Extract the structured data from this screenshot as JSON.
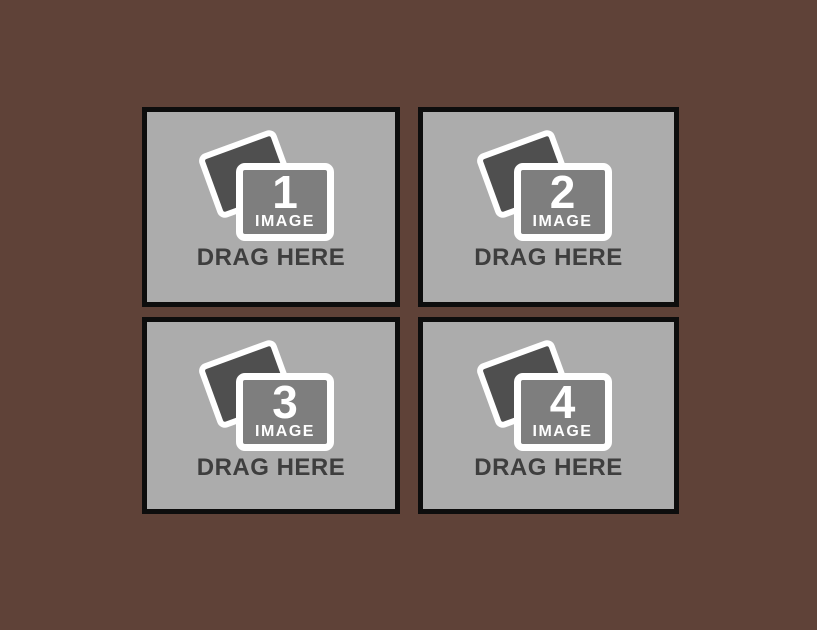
{
  "colors": {
    "bg": "#5f4238",
    "panel": "#acacac",
    "panel-border": "#0d0d0d",
    "frame": "#ffffff",
    "photo-dark": "#4f4f4f",
    "photo-mid": "#7e7e7e",
    "label-text": "#3e3e3e"
  },
  "dropzones": [
    {
      "number": "1",
      "image_label": "IMAGE",
      "drag_label": "DRAG HERE"
    },
    {
      "number": "2",
      "image_label": "IMAGE",
      "drag_label": "DRAG HERE"
    },
    {
      "number": "3",
      "image_label": "IMAGE",
      "drag_label": "DRAG HERE"
    },
    {
      "number": "4",
      "image_label": "IMAGE",
      "drag_label": "DRAG HERE"
    }
  ]
}
